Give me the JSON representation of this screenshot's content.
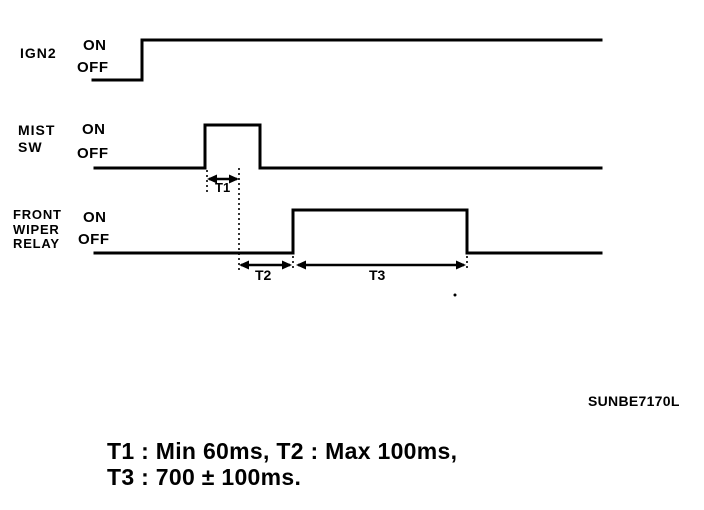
{
  "figure": {
    "code": "SUNBE7170L",
    "caption": {
      "line1": "T1 : Min 60ms, T2 : Max 100ms,",
      "line2": "T3 : 700 ± 100ms."
    },
    "ink_color": "#000000",
    "background_color": "#ffffff"
  },
  "signals": [
    {
      "id": "ign2",
      "label_lines": [
        "IGN2"
      ],
      "on_label": "ON",
      "off_label": "OFF",
      "x_start": 93,
      "x_end": 601,
      "y_on": 40,
      "y_off": 80,
      "edges": [
        {
          "x": 142,
          "to": "on"
        }
      ]
    },
    {
      "id": "mist-sw",
      "label_lines": [
        "MIST",
        "SW"
      ],
      "on_label": "ON",
      "off_label": "OFF",
      "x_start": 95,
      "x_end": 601,
      "y_on": 125,
      "y_off": 168,
      "edges": [
        {
          "x": 205,
          "to": "on"
        },
        {
          "x": 260,
          "to": "off"
        }
      ]
    },
    {
      "id": "front-wiper-relay",
      "label_lines": [
        "FRONT",
        "WIPER",
        "RELAY"
      ],
      "on_label": "ON",
      "off_label": "OFF",
      "x_start": 95,
      "x_end": 601,
      "y_on": 210,
      "y_off": 253,
      "edges": [
        {
          "x": 293,
          "to": "on"
        },
        {
          "x": 467,
          "to": "off"
        }
      ]
    }
  ],
  "markers": [
    {
      "label": "T1",
      "x1": 207,
      "x2": 239,
      "y": 179
    },
    {
      "label": "T2",
      "x1": 239,
      "x2": 292,
      "y": 265
    },
    {
      "label": "T3",
      "x1": 296,
      "x2": 466,
      "y": 265
    }
  ],
  "dotted_lines": [
    {
      "x": 207,
      "y1": 170,
      "y2": 194
    },
    {
      "x": 239,
      "y1": 168,
      "y2": 271
    },
    {
      "x": 293,
      "y1": 256,
      "y2": 271
    },
    {
      "x": 467,
      "y1": 256,
      "y2": 271
    }
  ]
}
